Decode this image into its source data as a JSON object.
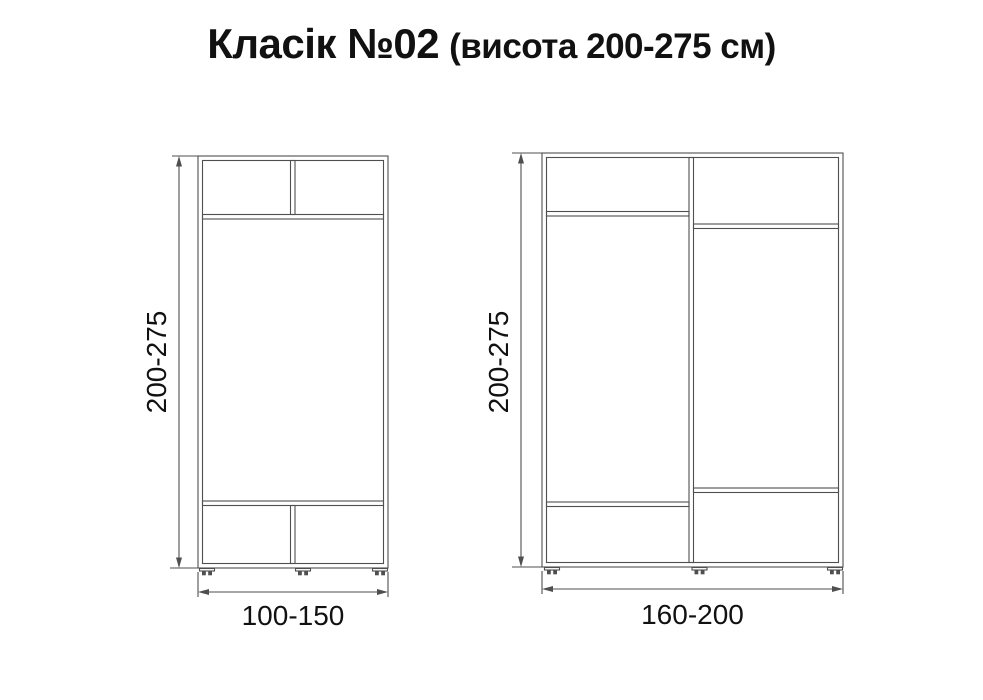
{
  "title": {
    "main": "Класік №02",
    "sub": "(висота 200-275 см)"
  },
  "wardrobes": [
    {
      "name": "narrow-wardrobe",
      "height_label": "200-275",
      "width_label": "100-150",
      "sections": "two top compartments, tall middle compartment, two bottom compartments"
    },
    {
      "name": "wide-wardrobe",
      "height_label": "200-275",
      "width_label": "160-200",
      "sections": "two vertical halves, each with top shelf and bottom shelf"
    }
  ],
  "colors": {
    "line": "#4f4f4f",
    "text": "#111111",
    "background": "#ffffff"
  }
}
